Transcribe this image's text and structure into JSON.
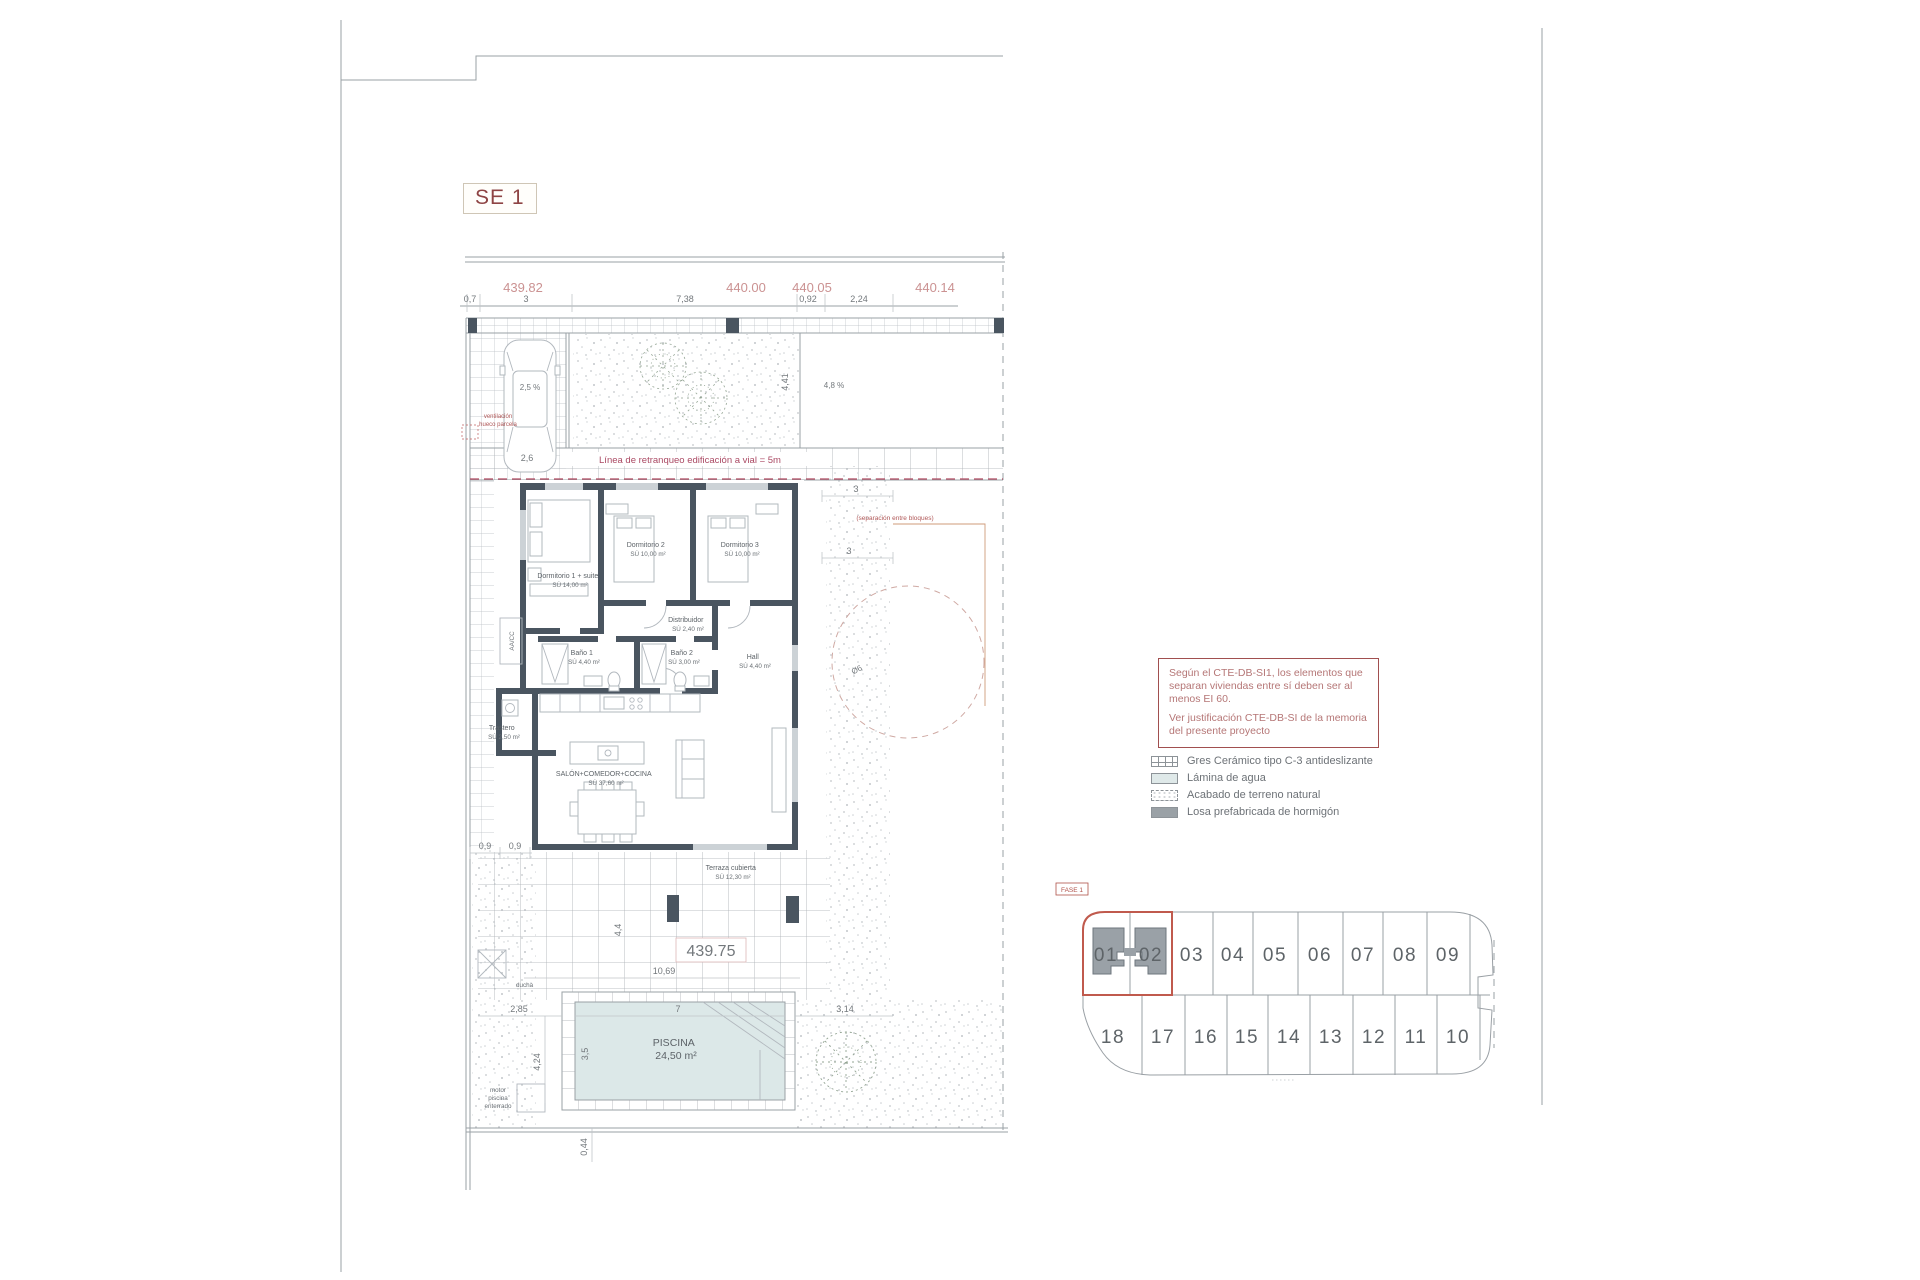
{
  "sheet": {
    "label": "SE 1"
  },
  "top_dims": {
    "elevations": [
      "439.82",
      "440.00",
      "440.05",
      "440.14"
    ],
    "segments": [
      "0,7",
      "3",
      "7,38",
      "0,92",
      "2,24"
    ]
  },
  "plan": {
    "slope_driveway": "2,5 %",
    "driveway_width": "2,6",
    "vent_note": [
      "ventilación",
      "hueco parcela"
    ],
    "setback_label": "Línea de retranqueo edificación a vial = 5m",
    "dim_depth": "4,41",
    "slope_garden": "4,8 %",
    "dim_side_a": "3",
    "dim_side_b": "3",
    "separation_note": "(separación entre bloques)",
    "circle_dia": "Ø6",
    "aacc": "AA/CC",
    "rooms": {
      "dorm1": {
        "name": "Dormitorio 1 + suite",
        "area": "SÚ 14,00 m²"
      },
      "dorm2": {
        "name": "Dormitorio 2",
        "area": "SÚ 10,00 m²"
      },
      "dorm3": {
        "name": "Dormitorio 3",
        "area": "SÚ 10,00 m²"
      },
      "distribuidor": {
        "name": "Distribuidor",
        "area": "SÚ 2,40 m²"
      },
      "bano1": {
        "name": "Baño 1",
        "area": "SÚ 4,40 m²"
      },
      "bano2": {
        "name": "Baño 2",
        "area": "SÚ 3,00 m²"
      },
      "hall": {
        "name": "Hall",
        "area": "SÚ 4,40 m²"
      },
      "trastero": {
        "name": "Trastero",
        "area": "SÚ 2,50 m²"
      },
      "salon": {
        "name": "SALÓN+COMEDOR+COCINA",
        "area": "SÚ 37,60 m²"
      },
      "terraza": {
        "name": "Terraza cubierta",
        "area": "SÚ 12,30 m²"
      }
    },
    "elevation_terrace": "439.75",
    "ducha": "ducha",
    "motor": [
      "motor",
      "piscina",
      "enterrado"
    ],
    "pool": {
      "name": "PISCINA",
      "area": "24,50 m²"
    },
    "dims": {
      "d09a": "0,9",
      "d09b": "0,9",
      "d44": "4,4",
      "d1069": "10,69",
      "d285": "2,85",
      "d424": "4,24",
      "d7": "7",
      "d35": "3,5",
      "d314": "3,14",
      "d044": "0,44"
    }
  },
  "note_box": {
    "line1": "Según el CTE-DB-SI1, los elementos que separan viviendas entre sí deben ser al menos EI 60.",
    "line2": "Ver justificación CTE-DB-SI de la memoria del presente proyecto"
  },
  "legend": {
    "items": [
      {
        "label": "Gres Cerámico tipo C-3 antideslizante"
      },
      {
        "label": "Lámina de agua"
      },
      {
        "label": "Acabado de terreno natural"
      },
      {
        "label": "Losa prefabricada de hormigón"
      }
    ]
  },
  "plots": {
    "fase": "FASE 1",
    "top": [
      "01",
      "02",
      "03",
      "04",
      "05",
      "06",
      "07",
      "08",
      "09"
    ],
    "bottom": [
      "18",
      "17",
      "16",
      "15",
      "14",
      "13",
      "12",
      "11",
      "10"
    ]
  }
}
